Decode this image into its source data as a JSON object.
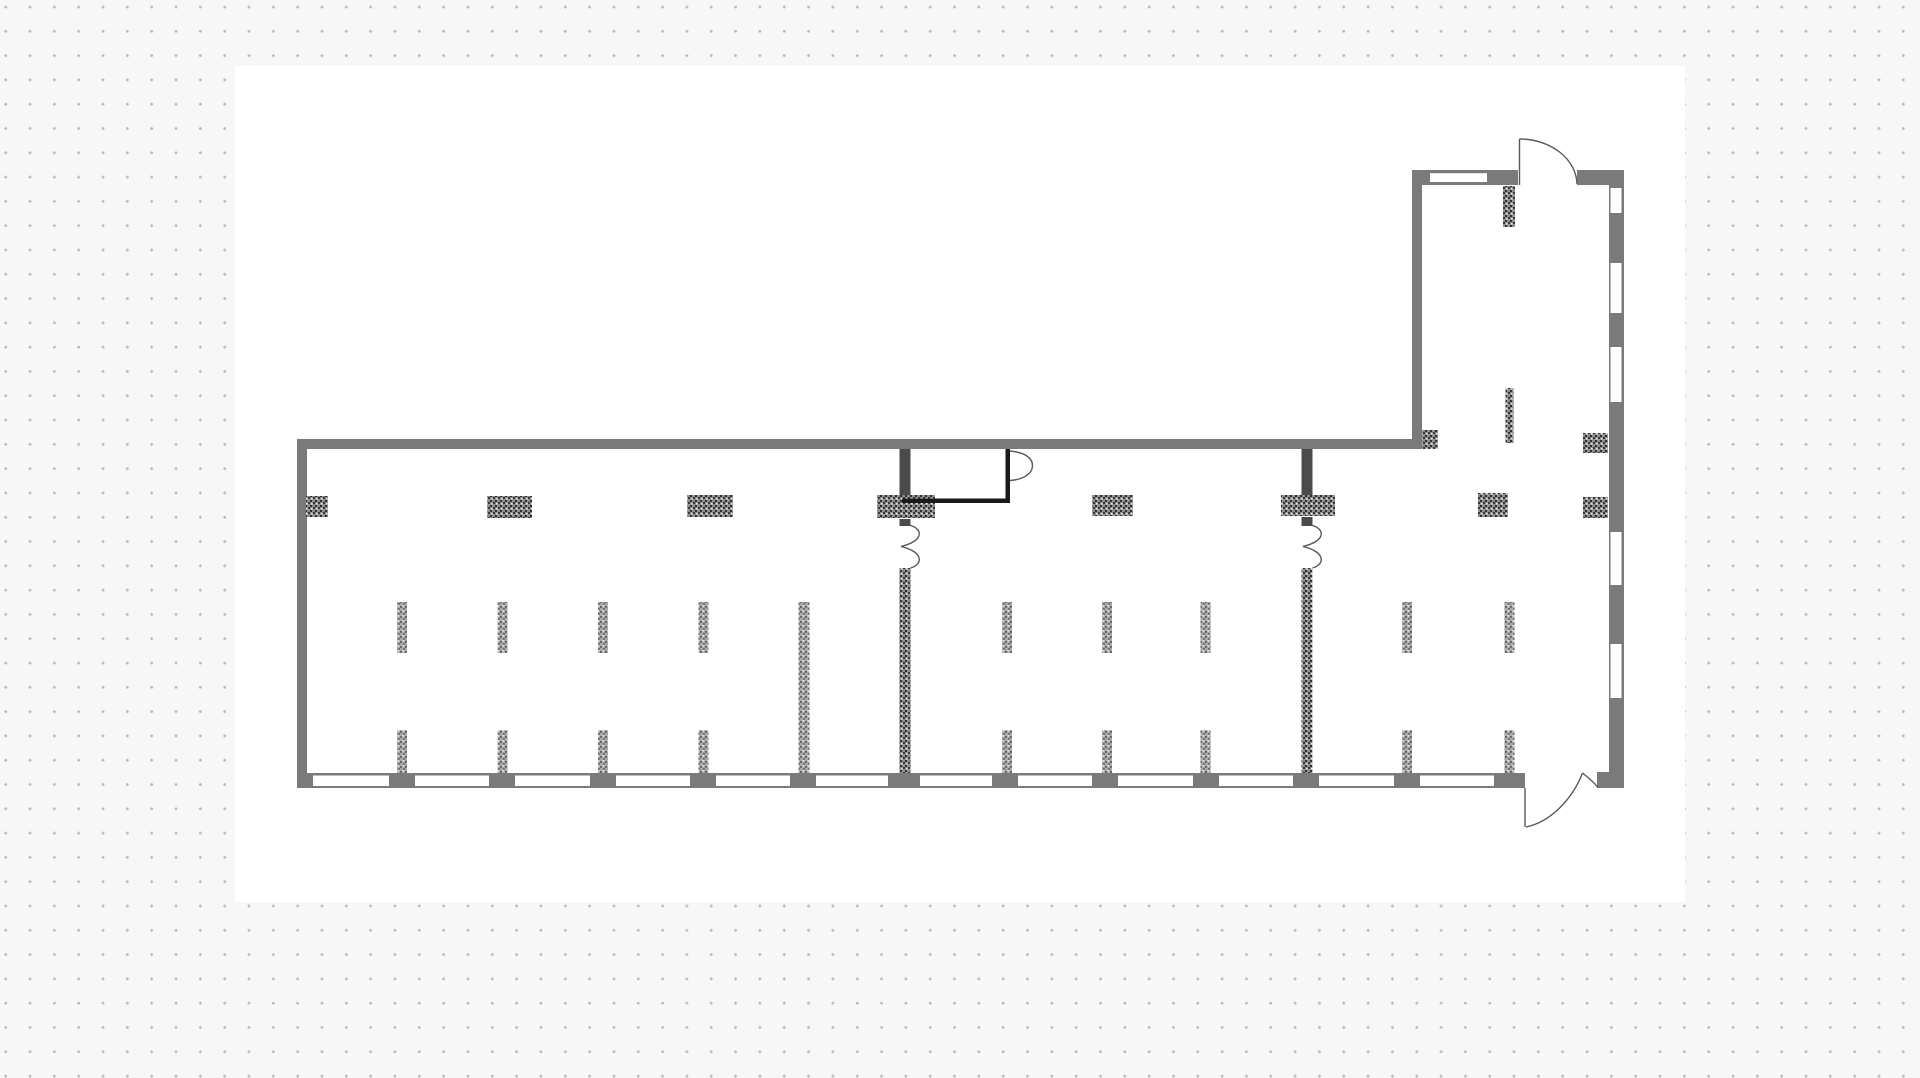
{
  "app": {
    "type": "floor-plan-canvas",
    "colors": {
      "page_bg": "#f7f7f7",
      "dot": "#b3b3b3",
      "canvas": "#ffffff",
      "wall": "#7a7a7a",
      "partition": "#4b4b4b",
      "line": "#1a1a1a",
      "door_arc": "#585858",
      "window": "#ffffff"
    },
    "grid": {
      "pitch_x": 24.33,
      "pitch_y": 24.3,
      "dot_size": 2.4
    }
  },
  "canvas": {
    "x": 235,
    "y": 66,
    "width": 1450,
    "height": 836
  },
  "floorplan": {
    "walls": [
      {
        "name": "main-top-wall",
        "x": 298,
        "y": 439,
        "w": 1114,
        "h": 10
      },
      {
        "name": "left-wall",
        "x": 297,
        "y": 439,
        "w": 10,
        "h": 349
      },
      {
        "name": "bottom-wall",
        "x": 297,
        "y": 773,
        "w": 1228,
        "h": 15
      },
      {
        "name": "right-wall",
        "x": 1609,
        "y": 170,
        "w": 15,
        "h": 618
      },
      {
        "name": "right-wall-foot",
        "x": 1597,
        "y": 772,
        "w": 27,
        "h": 16
      },
      {
        "name": "annex-top-wall-left",
        "x": 1412,
        "y": 170,
        "w": 106,
        "h": 15
      },
      {
        "name": "annex-top-wall-right",
        "x": 1577,
        "y": 170,
        "w": 47,
        "h": 15
      },
      {
        "name": "annex-left-wall",
        "x": 1412,
        "y": 170,
        "w": 10,
        "h": 279
      },
      {
        "name": "partition-1-upper",
        "x": 899.5,
        "y": 449,
        "w": 11,
        "h": 47,
        "color": "partition"
      },
      {
        "name": "partition-1-door-stub",
        "x": 899.5,
        "y": 519,
        "w": 11,
        "h": 7,
        "color": "partition"
      },
      {
        "name": "partition-2-upper",
        "x": 1301.5,
        "y": 449,
        "w": 11,
        "h": 47,
        "color": "partition"
      },
      {
        "name": "partition-2-door-stub",
        "x": 1301.5,
        "y": 517,
        "w": 11,
        "h": 9,
        "color": "partition"
      }
    ],
    "windows": [
      {
        "name": "window-bottom-1",
        "x": 313,
        "y": 775.5,
        "w": 76,
        "h": 10.5
      },
      {
        "name": "window-bottom-2",
        "x": 415,
        "y": 775.5,
        "w": 74,
        "h": 10.5
      },
      {
        "name": "window-bottom-3",
        "x": 515,
        "y": 775.5,
        "w": 75,
        "h": 10.5
      },
      {
        "name": "window-bottom-4",
        "x": 616,
        "y": 775.5,
        "w": 74,
        "h": 10.5
      },
      {
        "name": "window-bottom-5",
        "x": 716,
        "y": 775.5,
        "w": 74,
        "h": 10.5
      },
      {
        "name": "window-bottom-6",
        "x": 816,
        "y": 775.5,
        "w": 72,
        "h": 10.5
      },
      {
        "name": "window-bottom-7",
        "x": 920,
        "y": 775.5,
        "w": 72,
        "h": 10.5
      },
      {
        "name": "window-bottom-8",
        "x": 1018,
        "y": 775.5,
        "w": 74,
        "h": 10.5
      },
      {
        "name": "window-bottom-9",
        "x": 1118,
        "y": 775.5,
        "w": 75,
        "h": 10.5
      },
      {
        "name": "window-bottom-10",
        "x": 1219,
        "y": 775.5,
        "w": 74,
        "h": 10.5
      },
      {
        "name": "window-bottom-11",
        "x": 1319,
        "y": 775.5,
        "w": 75,
        "h": 10.5
      },
      {
        "name": "window-bottom-12",
        "x": 1420,
        "y": 775.5,
        "w": 74,
        "h": 10.5
      },
      {
        "name": "window-right-1",
        "x": 1610.5,
        "y": 188,
        "w": 11,
        "h": 25
      },
      {
        "name": "window-right-2",
        "x": 1610.5,
        "y": 263,
        "w": 11,
        "h": 50
      },
      {
        "name": "window-right-3",
        "x": 1610.5,
        "y": 347,
        "w": 11,
        "h": 55
      },
      {
        "name": "window-right-4",
        "x": 1610.5,
        "y": 532,
        "w": 11,
        "h": 53
      },
      {
        "name": "window-right-5",
        "x": 1610.5,
        "y": 644,
        "w": 11,
        "h": 54
      },
      {
        "name": "window-annex-top",
        "x": 1430,
        "y": 173.2,
        "w": 57,
        "h": 8.8
      }
    ],
    "columns": [
      {
        "name": "column-left-wall",
        "x": 306,
        "y": 496,
        "w": 22,
        "h": 21
      },
      {
        "name": "column-2",
        "x": 487,
        "y": 496,
        "w": 45,
        "h": 22
      },
      {
        "name": "column-3",
        "x": 687,
        "y": 495,
        "w": 46,
        "h": 22
      },
      {
        "name": "column-partition-1",
        "x": 877,
        "y": 495,
        "w": 58,
        "h": 23
      },
      {
        "name": "column-5",
        "x": 1092,
        "y": 495,
        "w": 41,
        "h": 21
      },
      {
        "name": "column-partition-2",
        "x": 1281,
        "y": 495,
        "w": 54,
        "h": 21
      },
      {
        "name": "column-7",
        "x": 1478,
        "y": 493,
        "w": 30,
        "h": 24
      },
      {
        "name": "column-right-wall",
        "x": 1583,
        "y": 497,
        "w": 25,
        "h": 21
      },
      {
        "name": "column-annex-corner",
        "x": 1422,
        "y": 430,
        "w": 16,
        "h": 19
      },
      {
        "name": "column-annex-right",
        "x": 1583,
        "y": 433,
        "w": 25,
        "h": 20
      },
      {
        "name": "annex-top-pier",
        "x": 1503,
        "y": 186,
        "w": 12,
        "h": 41
      },
      {
        "name": "annex-mid-pier",
        "x": 1505.5,
        "y": 388,
        "w": 8,
        "h": 55
      },
      {
        "name": "partition-1-lower-wall",
        "x": 899.5,
        "y": 568,
        "w": 11,
        "h": 205
      },
      {
        "name": "partition-2-lower-wall",
        "x": 1301.5,
        "y": 568,
        "w": 11,
        "h": 205
      }
    ],
    "stubs": [
      {
        "name": "stub-upper-1",
        "x": 397,
        "y": 602,
        "w": 10,
        "h": 51
      },
      {
        "name": "stub-upper-2",
        "x": 497.5,
        "y": 602,
        "w": 10,
        "h": 51
      },
      {
        "name": "stub-upper-3",
        "x": 598,
        "y": 602,
        "w": 10,
        "h": 51
      },
      {
        "name": "stub-upper-4",
        "x": 698.5,
        "y": 602,
        "w": 10,
        "h": 51
      },
      {
        "name": "stub-upper-5",
        "x": 1002,
        "y": 602,
        "w": 10,
        "h": 51
      },
      {
        "name": "stub-upper-6",
        "x": 1102,
        "y": 602,
        "w": 10,
        "h": 51
      },
      {
        "name": "stub-upper-7",
        "x": 1200.5,
        "y": 602,
        "w": 10,
        "h": 51
      },
      {
        "name": "stub-upper-8",
        "x": 1402,
        "y": 602,
        "w": 10,
        "h": 51
      },
      {
        "name": "stub-upper-9",
        "x": 1504.5,
        "y": 602,
        "w": 10,
        "h": 51
      },
      {
        "name": "stub-tall",
        "x": 798.5,
        "y": 602,
        "w": 11,
        "h": 171
      },
      {
        "name": "stub-lower-1",
        "x": 397,
        "y": 730,
        "w": 10,
        "h": 43
      },
      {
        "name": "stub-lower-2",
        "x": 497.5,
        "y": 730,
        "w": 10,
        "h": 43
      },
      {
        "name": "stub-lower-3",
        "x": 598,
        "y": 730,
        "w": 10,
        "h": 43
      },
      {
        "name": "stub-lower-4",
        "x": 698.5,
        "y": 730,
        "w": 10,
        "h": 43
      },
      {
        "name": "stub-lower-5",
        "x": 1002,
        "y": 730,
        "w": 10,
        "h": 43
      },
      {
        "name": "stub-lower-6",
        "x": 1102,
        "y": 730,
        "w": 10,
        "h": 43
      },
      {
        "name": "stub-lower-7",
        "x": 1200.5,
        "y": 730,
        "w": 10,
        "h": 43
      },
      {
        "name": "stub-lower-8",
        "x": 1402,
        "y": 730,
        "w": 10,
        "h": 43
      },
      {
        "name": "stub-lower-9",
        "x": 1504.5,
        "y": 730,
        "w": 10,
        "h": 43
      }
    ],
    "thin_lines": [
      {
        "name": "inner-room-bottom-line",
        "x": 902,
        "y": 498.5,
        "w": 108,
        "h": 4.5
      },
      {
        "name": "inner-room-right-line",
        "x": 1005.5,
        "y": 449,
        "w": 4.5,
        "h": 54
      }
    ],
    "door_paths": [
      {
        "name": "annex-door-leaf",
        "d": "M 1519.5 185 L 1519.5 139"
      },
      {
        "name": "annex-door-arc",
        "d": "M 1519.5 139 A 57.5 46 0 0 1 1577 184"
      },
      {
        "name": "inner-room-door-arc",
        "d": "M 1010 451 C 1025 452.5 1032.5 458 1032.5 465.5 C 1032.5 474 1023 479.5 1010 480.5"
      },
      {
        "name": "partition-1-door-arcs",
        "d": "M 910.5 525.5 C 923 529 924 541 901 546.5 C 924 552 923 564.5 910.5 568"
      },
      {
        "name": "partition-2-door-arcs",
        "d": "M 1312.5 525.5 C 1325 529 1326 541 1303 546.5 C 1326 552 1325 564.5 1312.5 568"
      },
      {
        "name": "exit-door-leaf",
        "d": "M 1525 788 L 1525 827"
      },
      {
        "name": "exit-door-arc",
        "d": "M 1526 827 C 1550 822 1572 800 1582.5 773"
      },
      {
        "name": "exit-door-arc-2",
        "d": "M 1582.5 773 C 1590 779 1595 783.5 1598 787.5"
      }
    ]
  }
}
